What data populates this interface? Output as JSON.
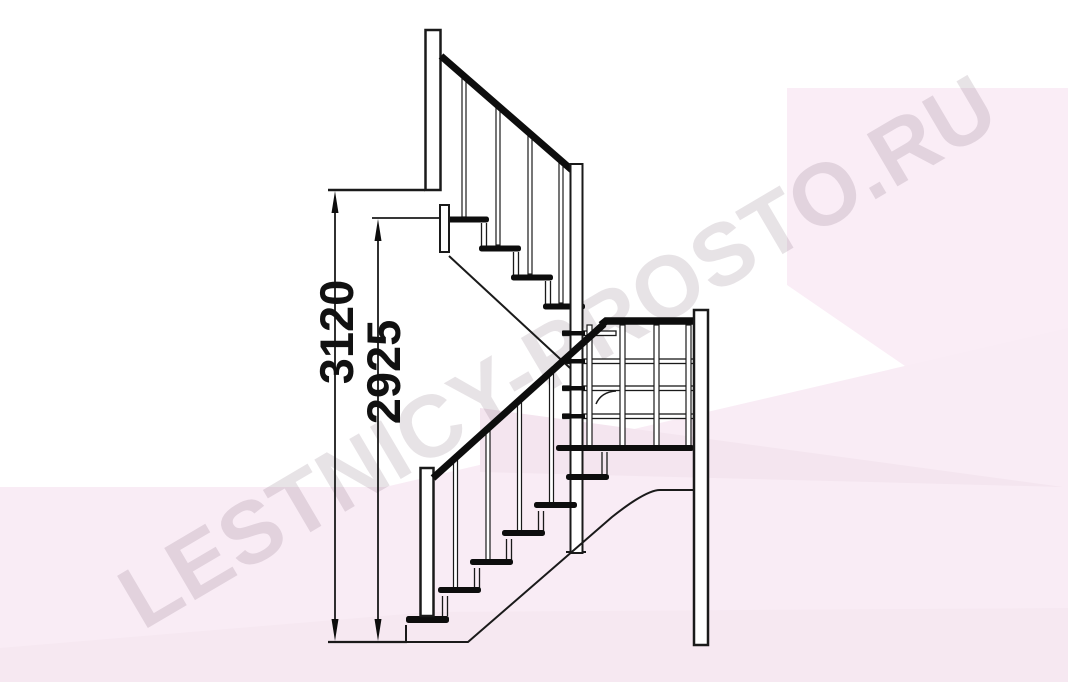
{
  "title": "Staircase elevation drawing (L-shaped stair with winder)",
  "watermark": {
    "text": "LESTNICY-PROSTO.RU"
  },
  "dimensions": {
    "total_height": {
      "value": "3120",
      "orientation": "vertical",
      "unit_note": "mm (implied)"
    },
    "secondary_height": {
      "value": "2925",
      "orientation": "vertical",
      "unit_note": "mm (implied)"
    }
  },
  "diagram": {
    "type": "staircase-side-elevation",
    "upper_flight_treads": 4,
    "lower_flight_treads": 6,
    "winder_levels": 5,
    "posts": [
      "upper-newel",
      "middle-post",
      "lower-newel",
      "right-post"
    ],
    "handrails": [
      "upper-descending",
      "winder-horizontal",
      "lower-ascending"
    ]
  },
  "colors": {
    "line": "#1a1a1a",
    "tread_fill": "#0d0d0d",
    "background": "#ffffff",
    "watermark_pink_1": "#faedf6",
    "watermark_pink_2": "#f9ecf5",
    "watermark_pink_3": "#f4e5ef",
    "watermark_text": "rgba(95,65,90,0.15)"
  }
}
